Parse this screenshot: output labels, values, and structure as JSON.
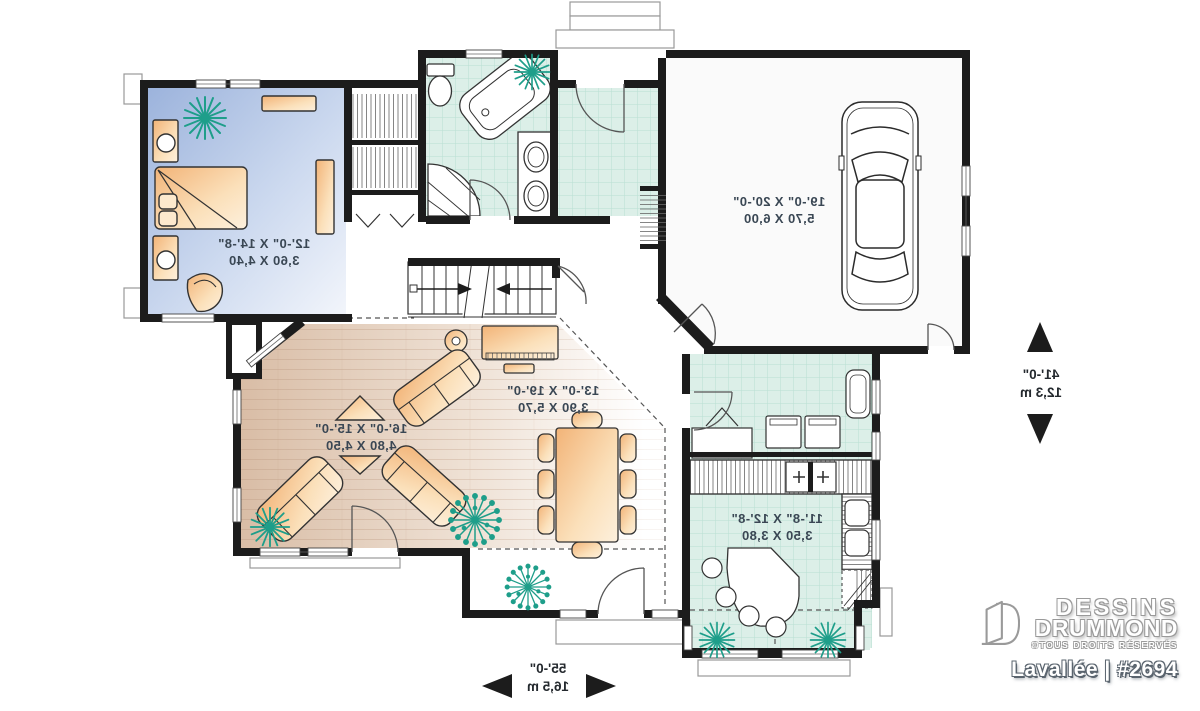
{
  "plan": {
    "rooms": [
      {
        "id": "bedroom",
        "dim_imperial": "12'-0\" X 14'-8\"",
        "dim_metric": "3,60 X 4,40"
      },
      {
        "id": "garage",
        "dim_imperial": "19'-0\" X 20'-0\"",
        "dim_metric": "5,70 X 6,00"
      },
      {
        "id": "dining",
        "dim_imperial": "13'-0\" X 19'-0\"",
        "dim_metric": "3,90 X 5,70"
      },
      {
        "id": "living",
        "dim_imperial": "16'-0\" X 15'-0\"",
        "dim_metric": "4,80 X 4,50"
      },
      {
        "id": "kitchen",
        "dim_imperial": "11'-8\" X 12'-8\"",
        "dim_metric": "3,50 X 3,80"
      }
    ],
    "overall_depth": {
      "imperial": "41'-0\"",
      "metric": "12,3 m"
    },
    "overall_width": {
      "imperial": "55'-0\"",
      "metric": "16,5 m"
    },
    "text_is_mirrored": true
  },
  "branding": {
    "company_line1": "DESSINS",
    "company_line2": "DRUMMOND",
    "rights": "©TOUS DROITS RÉSERVÉS",
    "model": "Lavallée | #2694"
  },
  "symbols": {
    "plant_icon": "teal-starburst-plant",
    "stairs_up_icon": "arrow-right",
    "stairs_down_icon": "arrow-left",
    "depth_dimension_icon": "up-down-solid-triangles",
    "width_dimension_icon": "left-right-solid-triangles",
    "logo_icon": "open-door-D"
  },
  "colors": {
    "walls": "#1c1c1c",
    "bedroom_floor": "#9cb3dc",
    "wood_floor": "#d9bda6",
    "tile_floor": "#dcefe8",
    "furniture": "#f2b377",
    "plants": "#1e9e8a",
    "label_text": "#3a4754"
  }
}
